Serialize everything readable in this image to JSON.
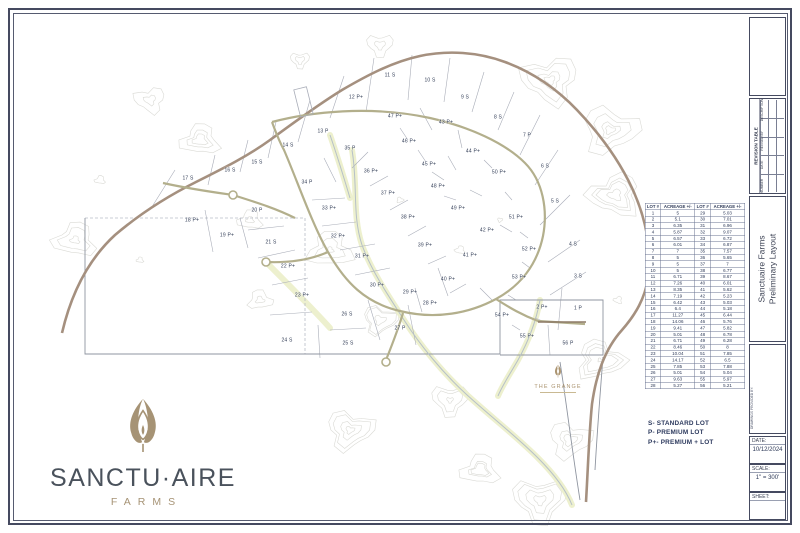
{
  "sheet_title": "Sanctuaire Farms Preliminary Layout",
  "colors": {
    "accent_navy": "#3b4560",
    "brand_tan": "#a69375",
    "brand_slate": "#4a525c",
    "contour_gray": "#dadad5",
    "road_olive": "#b3af8c",
    "road_brown": "#a5907f",
    "creek_blue": "#b6c0c8",
    "highlight_yellow": "#edf0cc"
  },
  "logo": {
    "wordmark": "SANCTU·AIRE",
    "sub": "FARMS",
    "emblem_icon": "leaf-bud-icon"
  },
  "legend": {
    "items": [
      "S- STANDARD LOT",
      "P- PREMIUM LOT",
      "P+- PREMIUM + LOT"
    ]
  },
  "lot_table": {
    "headers": [
      "LOT #",
      "ACREAGE +/-",
      "LOT #",
      "ACREAGE +/-"
    ],
    "rows": [
      [
        "1",
        "5",
        "29",
        "5.03"
      ],
      [
        "2",
        "5.1",
        "30",
        "7.01"
      ],
      [
        "3",
        "6.35",
        "31",
        "6.96"
      ],
      [
        "4",
        "5.87",
        "32",
        "9.07"
      ],
      [
        "5",
        "6.57",
        "33",
        "6.72"
      ],
      [
        "6",
        "6.01",
        "34",
        "6.87"
      ],
      [
        "7",
        "7",
        "35",
        "7.57"
      ],
      [
        "8",
        "5",
        "36",
        "5.65"
      ],
      [
        "9",
        "5",
        "37",
        "7"
      ],
      [
        "10",
        "5",
        "38",
        "6.77"
      ],
      [
        "11",
        "6.71",
        "39",
        "8.67"
      ],
      [
        "12",
        "7.26",
        "40",
        "6.01"
      ],
      [
        "13",
        "8.35",
        "41",
        "5.62"
      ],
      [
        "14",
        "7.19",
        "42",
        "5.23"
      ],
      [
        "15",
        "6.42",
        "43",
        "5.03"
      ],
      [
        "16",
        "6.4",
        "44",
        "5.18"
      ],
      [
        "17",
        "11.27",
        "45",
        "6.44"
      ],
      [
        "18",
        "14.06",
        "46",
        "5.76"
      ],
      [
        "19",
        "9.41",
        "47",
        "5.82"
      ],
      [
        "20",
        "5.01",
        "48",
        "6.78"
      ],
      [
        "21",
        "6.71",
        "49",
        "6.28"
      ],
      [
        "22",
        "8.46",
        "50",
        "8"
      ],
      [
        "23",
        "10.04",
        "51",
        "7.85"
      ],
      [
        "24",
        "14.17",
        "52",
        "6.5"
      ],
      [
        "25",
        "7.85",
        "53",
        "7.88"
      ],
      [
        "26",
        "5.01",
        "54",
        "5.04"
      ],
      [
        "27",
        "9.63",
        "55",
        "5.97"
      ],
      [
        "28",
        "5.27",
        "56",
        "5.21"
      ]
    ]
  },
  "map": {
    "grange_label": "THE GRANGE",
    "lots": [
      {
        "t": "1 P",
        "x": 578,
        "y": 309
      },
      {
        "t": "2 P+",
        "x": 542,
        "y": 308
      },
      {
        "t": "3 S",
        "x": 578,
        "y": 277
      },
      {
        "t": "4 S",
        "x": 573,
        "y": 245
      },
      {
        "t": "5 S",
        "x": 555,
        "y": 202
      },
      {
        "t": "6 S",
        "x": 545,
        "y": 167
      },
      {
        "t": "7 P",
        "x": 527,
        "y": 136
      },
      {
        "t": "8 S",
        "x": 498,
        "y": 118
      },
      {
        "t": "9 S",
        "x": 465,
        "y": 98
      },
      {
        "t": "10 S",
        "x": 430,
        "y": 81
      },
      {
        "t": "11 S",
        "x": 390,
        "y": 76
      },
      {
        "t": "12 P+",
        "x": 356,
        "y": 98
      },
      {
        "t": "13 P",
        "x": 323,
        "y": 132
      },
      {
        "t": "14 S",
        "x": 288,
        "y": 146
      },
      {
        "t": "15 S",
        "x": 257,
        "y": 163
      },
      {
        "t": "16 S",
        "x": 230,
        "y": 171
      },
      {
        "t": "17 S",
        "x": 188,
        "y": 179
      },
      {
        "t": "18 P+",
        "x": 192,
        "y": 221
      },
      {
        "t": "19 P+",
        "x": 227,
        "y": 236
      },
      {
        "t": "20 P",
        "x": 257,
        "y": 211
      },
      {
        "t": "21 S",
        "x": 271,
        "y": 243
      },
      {
        "t": "22 P+",
        "x": 288,
        "y": 267
      },
      {
        "t": "23 P+",
        "x": 302,
        "y": 296
      },
      {
        "t": "24 S",
        "x": 287,
        "y": 341
      },
      {
        "t": "25 S",
        "x": 348,
        "y": 344
      },
      {
        "t": "26 S",
        "x": 347,
        "y": 315
      },
      {
        "t": "27 P",
        "x": 400,
        "y": 329
      },
      {
        "t": "28 P+",
        "x": 430,
        "y": 304
      },
      {
        "t": "29 P+",
        "x": 410,
        "y": 293
      },
      {
        "t": "30 P+",
        "x": 377,
        "y": 286
      },
      {
        "t": "31 P+",
        "x": 362,
        "y": 257
      },
      {
        "t": "32 P+",
        "x": 338,
        "y": 237
      },
      {
        "t": "33 P+",
        "x": 329,
        "y": 209
      },
      {
        "t": "34 P",
        "x": 307,
        "y": 183
      },
      {
        "t": "35 P",
        "x": 350,
        "y": 149
      },
      {
        "t": "36 P+",
        "x": 371,
        "y": 172
      },
      {
        "t": "37 P+",
        "x": 388,
        "y": 194
      },
      {
        "t": "38 P+",
        "x": 408,
        "y": 218
      },
      {
        "t": "39 P+",
        "x": 425,
        "y": 246
      },
      {
        "t": "40 P+",
        "x": 448,
        "y": 280
      },
      {
        "t": "41 P+",
        "x": 470,
        "y": 256
      },
      {
        "t": "42 P+",
        "x": 487,
        "y": 231
      },
      {
        "t": "43 P+",
        "x": 446,
        "y": 123
      },
      {
        "t": "44 P+",
        "x": 473,
        "y": 152
      },
      {
        "t": "45 P+",
        "x": 429,
        "y": 165
      },
      {
        "t": "46 P+",
        "x": 409,
        "y": 142
      },
      {
        "t": "47 P+",
        "x": 395,
        "y": 117
      },
      {
        "t": "48 P+",
        "x": 438,
        "y": 187
      },
      {
        "t": "49 P+",
        "x": 458,
        "y": 209
      },
      {
        "t": "50 P+",
        "x": 499,
        "y": 173
      },
      {
        "t": "51 P+",
        "x": 516,
        "y": 218
      },
      {
        "t": "52 P+",
        "x": 529,
        "y": 250
      },
      {
        "t": "53 P+",
        "x": 519,
        "y": 278
      },
      {
        "t": "54 P+",
        "x": 502,
        "y": 316
      },
      {
        "t": "55 P+",
        "x": 527,
        "y": 337
      },
      {
        "t": "56 P",
        "x": 568,
        "y": 344
      }
    ]
  },
  "title_block": {
    "revision_table_title": "REVISION TABLE",
    "revision_columns": [
      "NUMBER",
      "DATE",
      "REVISED BY",
      "DESCRIPTION"
    ],
    "project_title_line1": "Sanctuaire Farms",
    "project_title_line2": "Preliminary Layout",
    "drawings_by_label": "DRAWINGS PROVIDED BY:",
    "date_label": "DATE:",
    "date_value": "10/12/2024",
    "scale_label": "SCALE:",
    "scale_value": "1\" = 300'",
    "sheet_label": "SHEET:"
  }
}
